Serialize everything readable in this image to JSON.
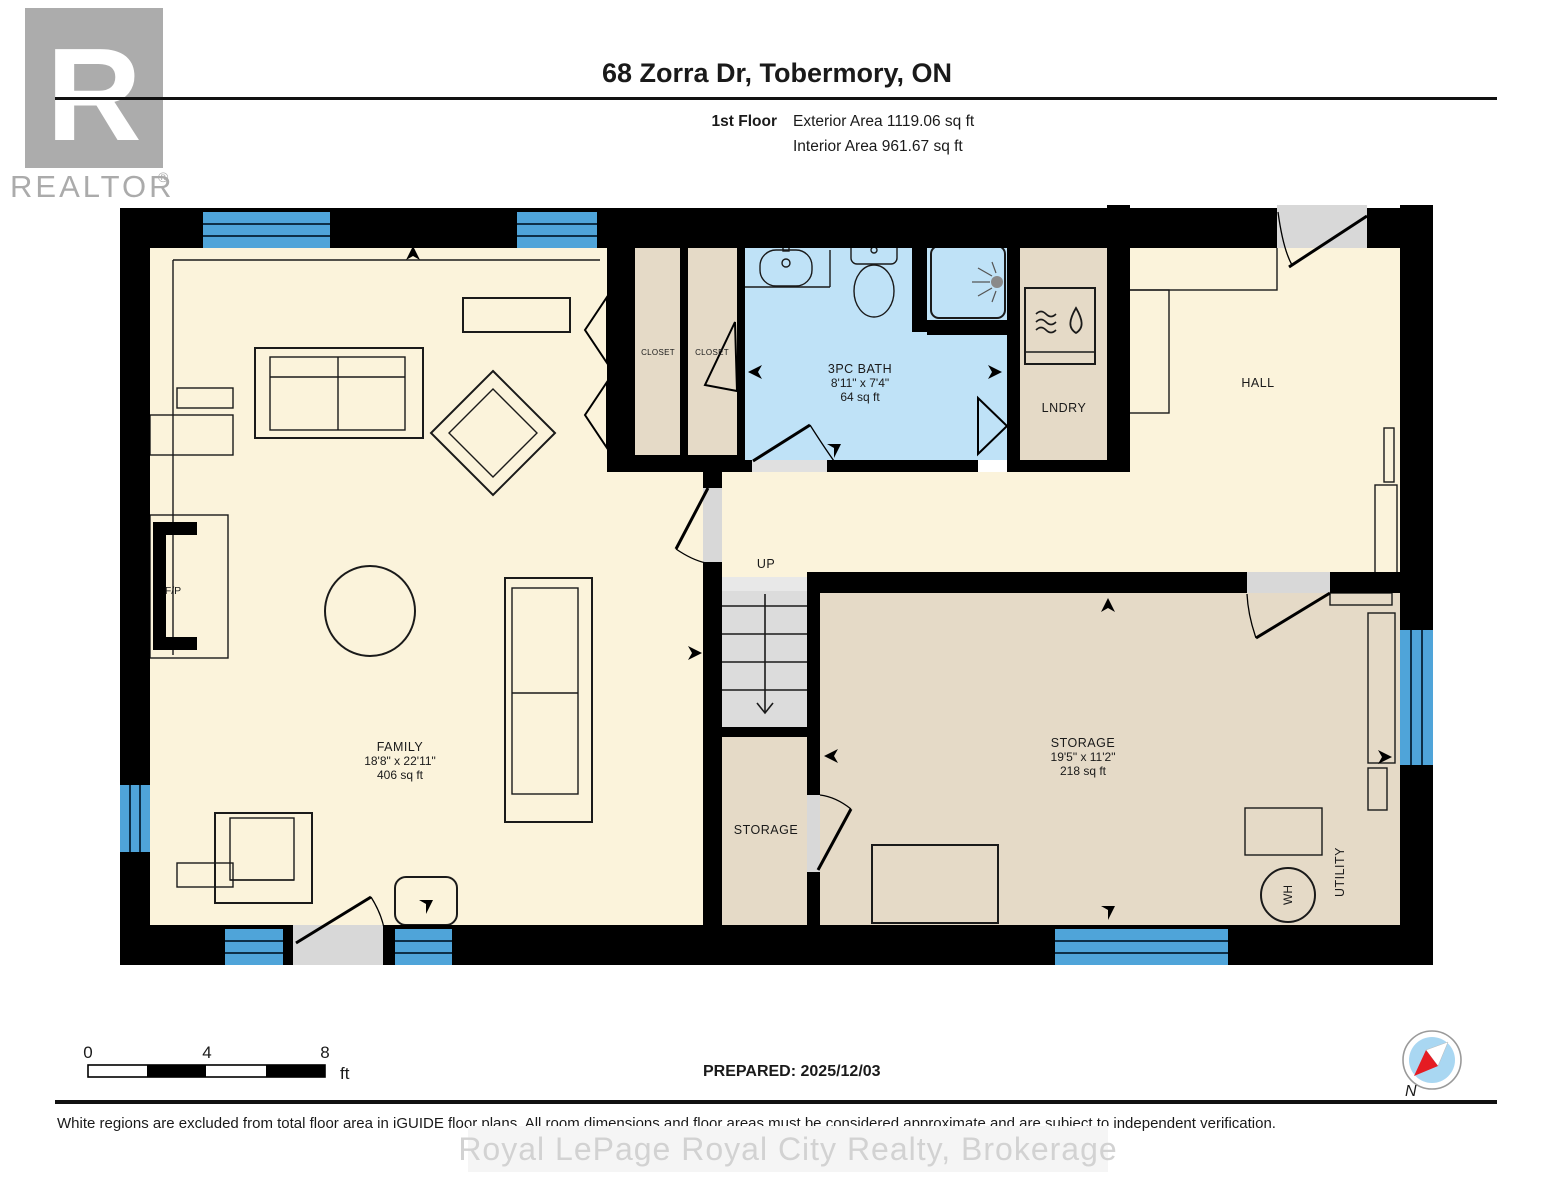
{
  "header": {
    "title": "68 Zorra Dr, Tobermory, ON",
    "floor_label": "1st Floor",
    "exterior_area": "Exterior Area 1119.06 sq ft",
    "interior_area": "Interior Area 961.67 sq ft"
  },
  "logo": {
    "letter": "R",
    "wordmark": "REALTOR",
    "registered": "®"
  },
  "rooms": {
    "family": {
      "name": "FAMILY",
      "dims": "18'8\" x 22'11\"",
      "area": "406 sq ft"
    },
    "bath": {
      "name": "3PC BATH",
      "dims": "8'11\" x 7'4\"",
      "area": "64 sq ft"
    },
    "storage": {
      "name": "STORAGE",
      "dims": "19'5\" x 11'2\"",
      "area": "218 sq ft"
    },
    "storage_small": {
      "name": "STORAGE"
    },
    "closet_left": {
      "name": "CLOSET"
    },
    "closet_right": {
      "name": "CLOSET"
    },
    "laundry": {
      "name": "LNDRY"
    },
    "hall": {
      "name": "HALL"
    },
    "utility": {
      "name": "UTILITY"
    },
    "stairs": {
      "name": "UP"
    },
    "fireplace": {
      "name": "F/P"
    },
    "water_heater": {
      "name": "WH"
    }
  },
  "scale_bar": {
    "tick_0": "0",
    "tick_4": "4",
    "tick_8": "8",
    "unit": "ft"
  },
  "prepared_label": "PREPARED: 2025/12/03",
  "compass": {
    "north_label": "N"
  },
  "footer": {
    "disclaimer": "White regions are excluded from total floor area in iGUIDE floor plans. All room dimensions and floor areas must be considered approximate and are subject to independent verification.",
    "watermark": "Royal LePage Royal City Realty, Brokerage"
  },
  "colors": {
    "floor_cream": "#FBF3DB",
    "floor_tan": "#E5DAC7",
    "floor_bath": "#BFE2F7",
    "window_blue": "#4FA4D9",
    "door_gray": "#D8D8D8",
    "wall_black": "#000000",
    "compass_blue": "#A9D7F2",
    "compass_red": "#E51C23"
  }
}
